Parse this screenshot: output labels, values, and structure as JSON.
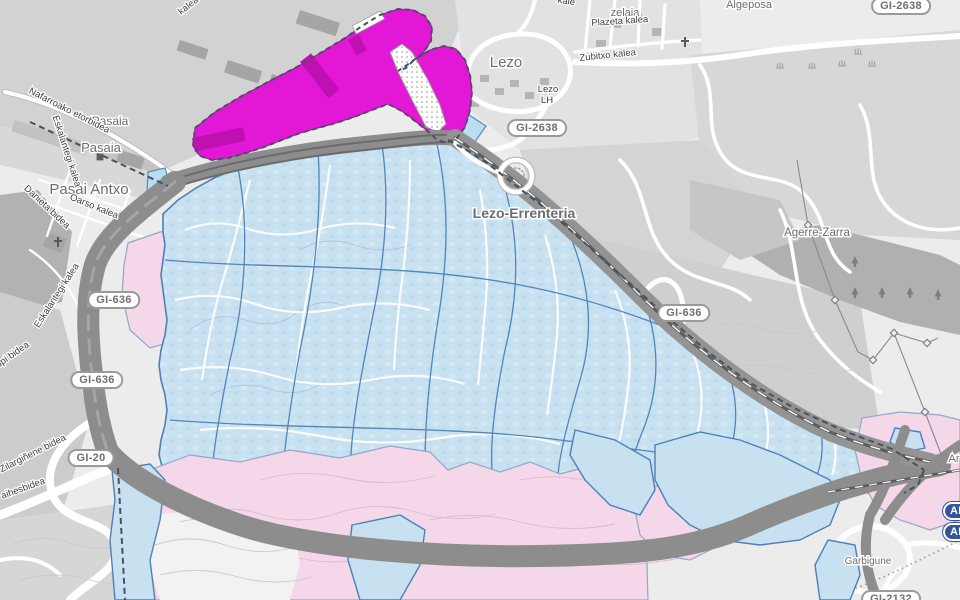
{
  "map": {
    "kind": "municipal zoning map over street basemap",
    "region": "Pasaia / Lezo / Errenteria (Gipuzkoa)"
  },
  "colors": {
    "overlay_blue": "#c7e1f1",
    "overlay_blue_border": "#4d80b8",
    "overlay_pink": "#f4d7e9",
    "overlay_pink_border": "#93a7c7",
    "overlay_magenta": "#e318d6",
    "magenta_building": "#bf10b2",
    "boundary_dash": "#47525e",
    "corridor_gray": "#8d8d8d",
    "water_blue": "#b9ddf1",
    "town_label": "#6d6d6d",
    "street_label": "#3f3f3f",
    "gi_badge_text": "#707070",
    "ap_badge_bg": "#35549b"
  },
  "places": [
    {
      "name": "Pasaia"
    },
    {
      "name": "Pasaia"
    },
    {
      "name": "Pasai Antxo"
    },
    {
      "name": "Lezo"
    },
    {
      "name": "Lezo-Errenteria"
    },
    {
      "name": "Agerre-Zarra"
    },
    {
      "name": "Garbigune"
    },
    {
      "name": "Algeposa"
    },
    {
      "name": "zelaia"
    },
    {
      "name": "Lezo"
    },
    {
      "name": "LH"
    },
    {
      "name": "Ar"
    }
  ],
  "streets": [
    {
      "name": "Nafarroako etorbidea"
    },
    {
      "name": "Eskalantegi kalea"
    },
    {
      "name": "Eskalantegi kalea"
    },
    {
      "name": "Oarso kalea"
    },
    {
      "name": "Danieta bidea"
    },
    {
      "name": "upi bidea"
    },
    {
      "name": "Zilargiñene bidea"
    },
    {
      "name": "aihesbidea"
    },
    {
      "name": "Plazeta kalea"
    },
    {
      "name": "Zubitxo kalea"
    },
    {
      "name": "kalea"
    },
    {
      "name": "kale"
    }
  ],
  "badges": [
    {
      "text": "GI-2638",
      "style": "gi"
    },
    {
      "text": "GI-2638",
      "style": "gi"
    },
    {
      "text": "GI-636",
      "style": "gi"
    },
    {
      "text": "GI-636",
      "style": "gi"
    },
    {
      "text": "GI-636",
      "style": "gi"
    },
    {
      "text": "GI-20",
      "style": "gi"
    },
    {
      "text": "GI-2132",
      "style": "gi"
    },
    {
      "text": "AP",
      "style": "ap"
    },
    {
      "text": "AP",
      "style": "ap"
    }
  ],
  "icons": [
    {
      "name": "church-cross-icon"
    },
    {
      "name": "church-cross-icon"
    },
    {
      "name": "railway-station-icon"
    },
    {
      "name": "railway-station-icon"
    },
    {
      "name": "power-pylon-icon"
    },
    {
      "name": "conifer-tree-icon"
    },
    {
      "name": "marsh-icon"
    }
  ]
}
